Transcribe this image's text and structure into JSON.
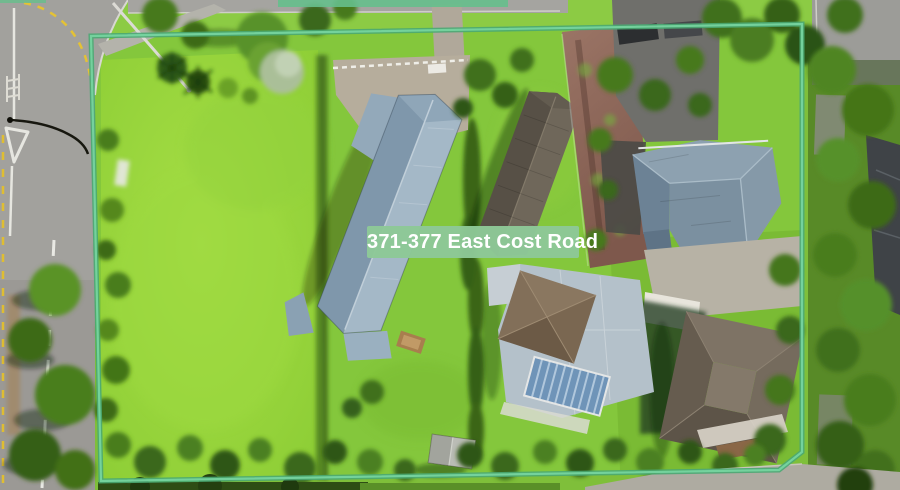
{
  "overlay": {
    "address_label": "371-377 East Cost Road",
    "badge_background": "#8dc897",
    "badge_text_color": "#ffffff",
    "boundary_color": "#55bc81"
  },
  "scene": {
    "kind": "aerial drone photograph of a residential property for sale",
    "features": {
      "boundary": "mint-green outline around the parcel",
      "road_left": "sealed road with white centre dashes, give-way triangle, crossing bars and yellow no-stopping dashes",
      "lawn": "large bright open lawn on the left of the parcel",
      "houses": [
        "long blue-grey hip-roof house",
        "dark grey gable-roof house",
        "blue-grey cross-hip-roof house",
        "brown hip-roof house with white veranda",
        "light-roof house with brown pyramid hip and glazed blue pergola"
      ],
      "driveways": [
        "concrete courtyard",
        "red-brown driveway",
        "dark asphalt driveway with parked cars"
      ],
      "vegetation": "tree rows along top, right and bottom edges, palms on lawn",
      "street_furniture": "street light poles"
    }
  }
}
